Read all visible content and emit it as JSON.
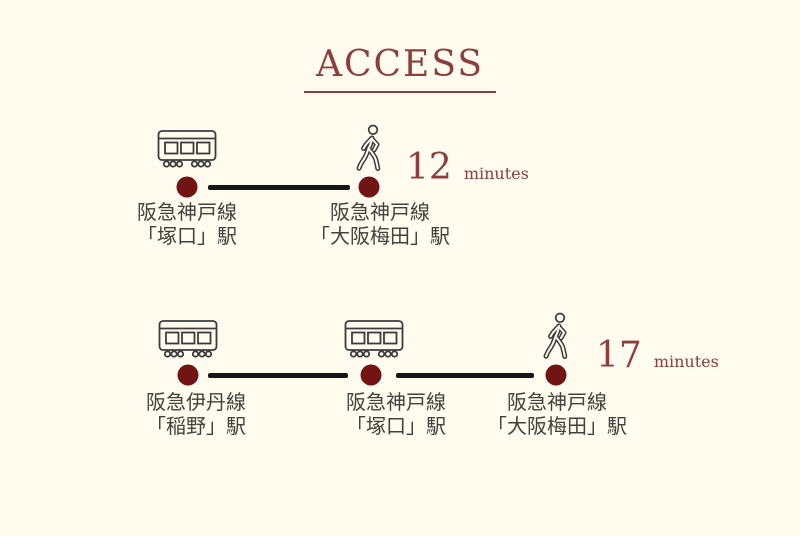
{
  "meta": {
    "background_color": "#fffbef",
    "accent_color": "#8d3e3e",
    "dot_color": "#721414",
    "route_line_color": "#161616",
    "label_color": "#43413b",
    "icon_color": "#3c3c3c"
  },
  "title": "ACCESS",
  "routes": [
    {
      "duration_value": "12",
      "duration_unit": "minutes",
      "stops": [
        {
          "icon": "train",
          "line": "阪急神戸線",
          "station": "「塚口」駅"
        },
        {
          "icon": "walk",
          "line": "阪急神戸線",
          "station": "「大阪梅田」駅"
        }
      ]
    },
    {
      "duration_value": "17",
      "duration_unit": "minutes",
      "stops": [
        {
          "icon": "train",
          "line": "阪急伊丹線",
          "station": "「稲野」駅"
        },
        {
          "icon": "train",
          "line": "阪急神戸線",
          "station": "「塚口」駅"
        },
        {
          "icon": "walk",
          "line": "阪急神戸線",
          "station": "「大阪梅田」駅"
        }
      ]
    }
  ]
}
